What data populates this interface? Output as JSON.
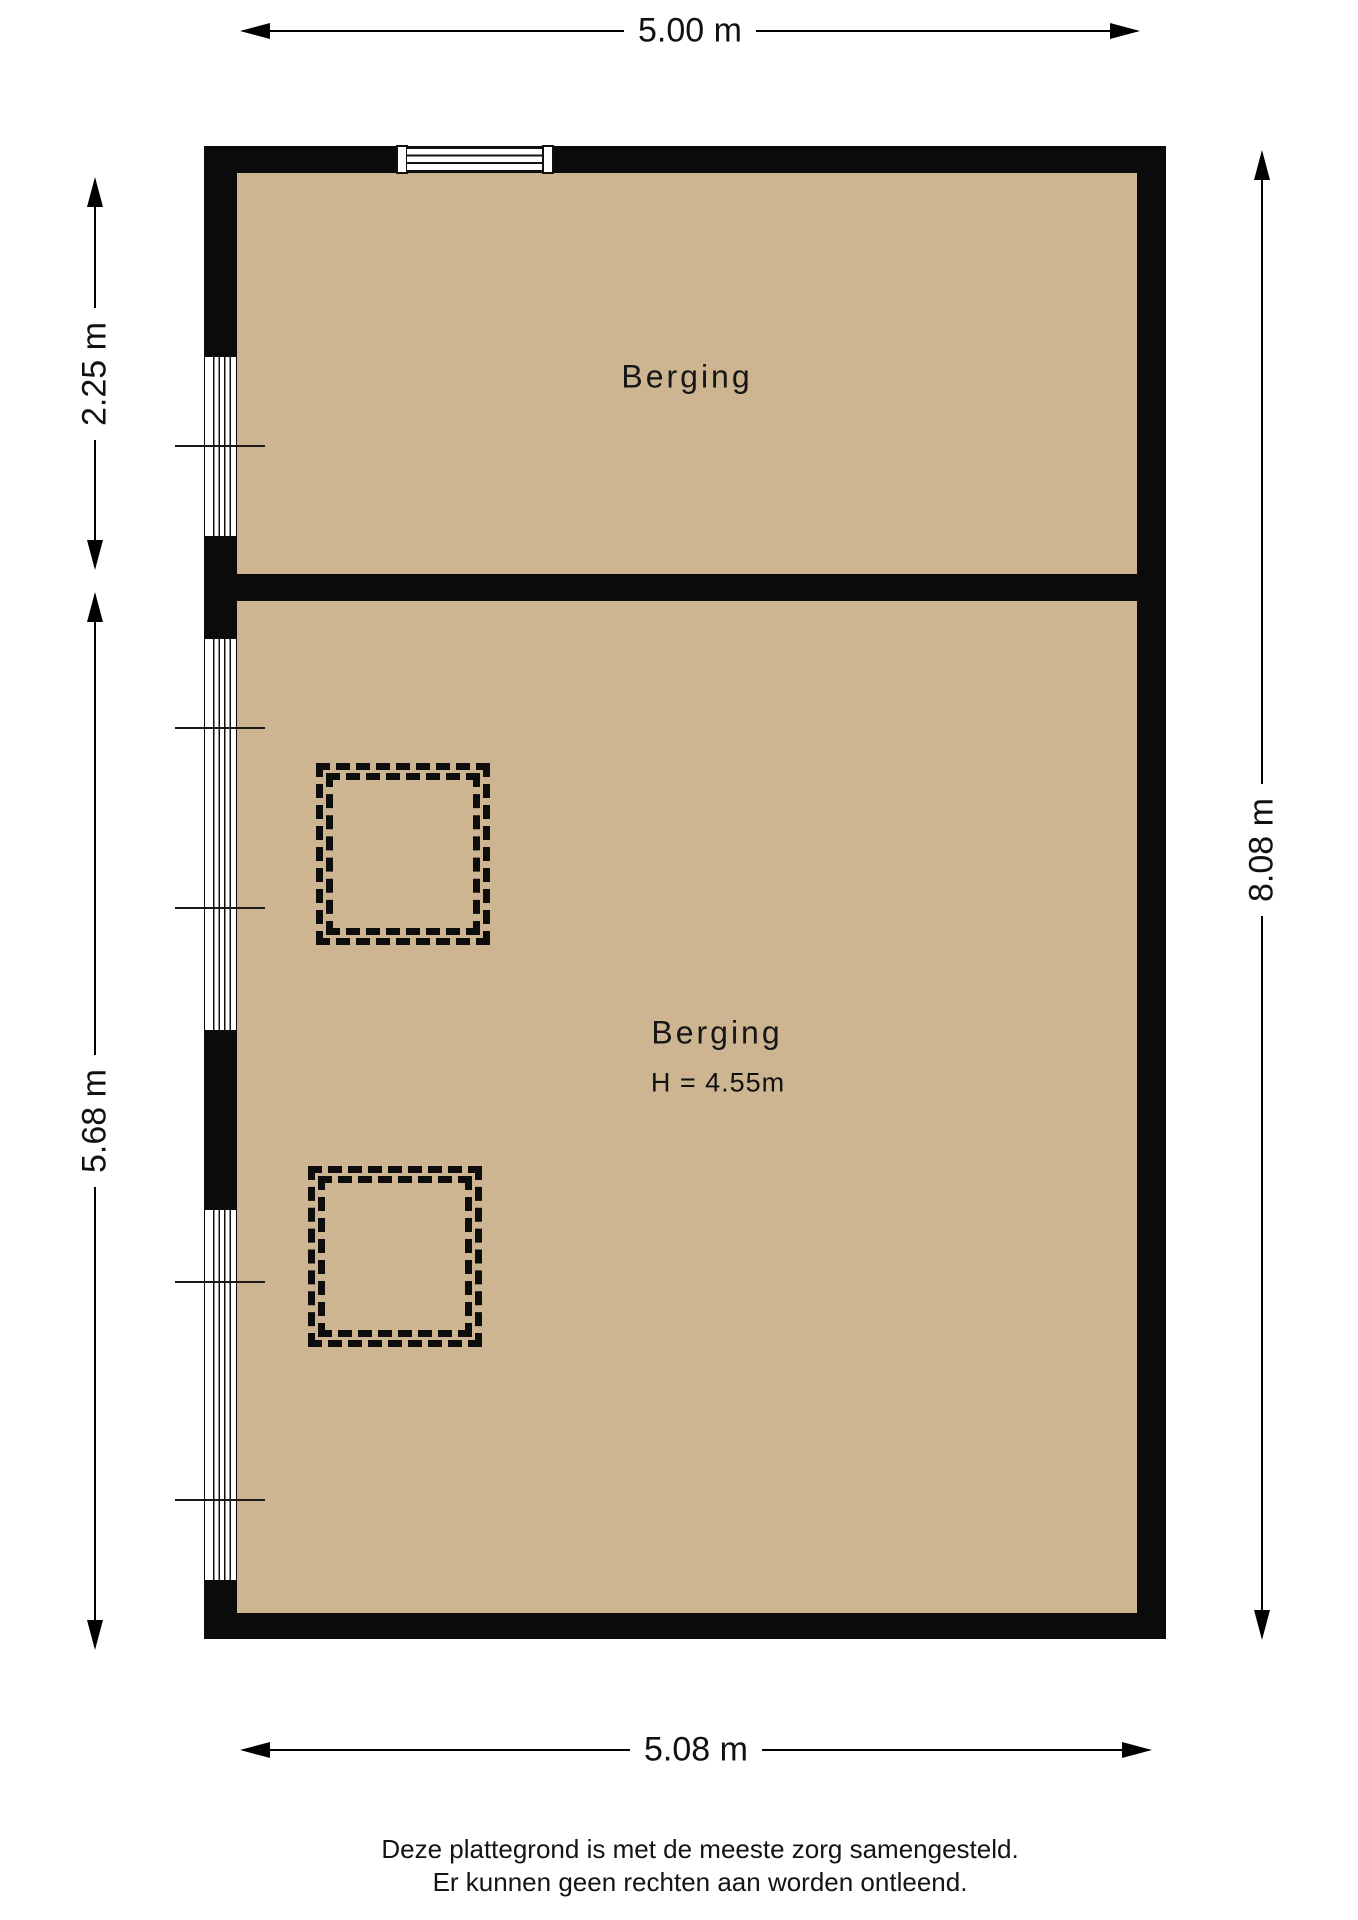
{
  "plan": {
    "rooms": [
      {
        "name": "Berging"
      },
      {
        "name": "Berging",
        "height_label": "H = 4.55m"
      }
    ],
    "dimensions": {
      "top": "5.00 m",
      "left_upper": "2.25 m",
      "left_lower": "5.68 m",
      "right": "8.08 m",
      "bottom": "5.08 m"
    },
    "disclaimer": {
      "line1": "Deze plattegrond is met de meeste zorg samengesteld.",
      "line2": "Er kunnen geen rechten aan worden ontleend."
    },
    "colors": {
      "floor": "#CDB592",
      "wall": "#0B0B0B",
      "background": "#FFFFFF"
    }
  }
}
